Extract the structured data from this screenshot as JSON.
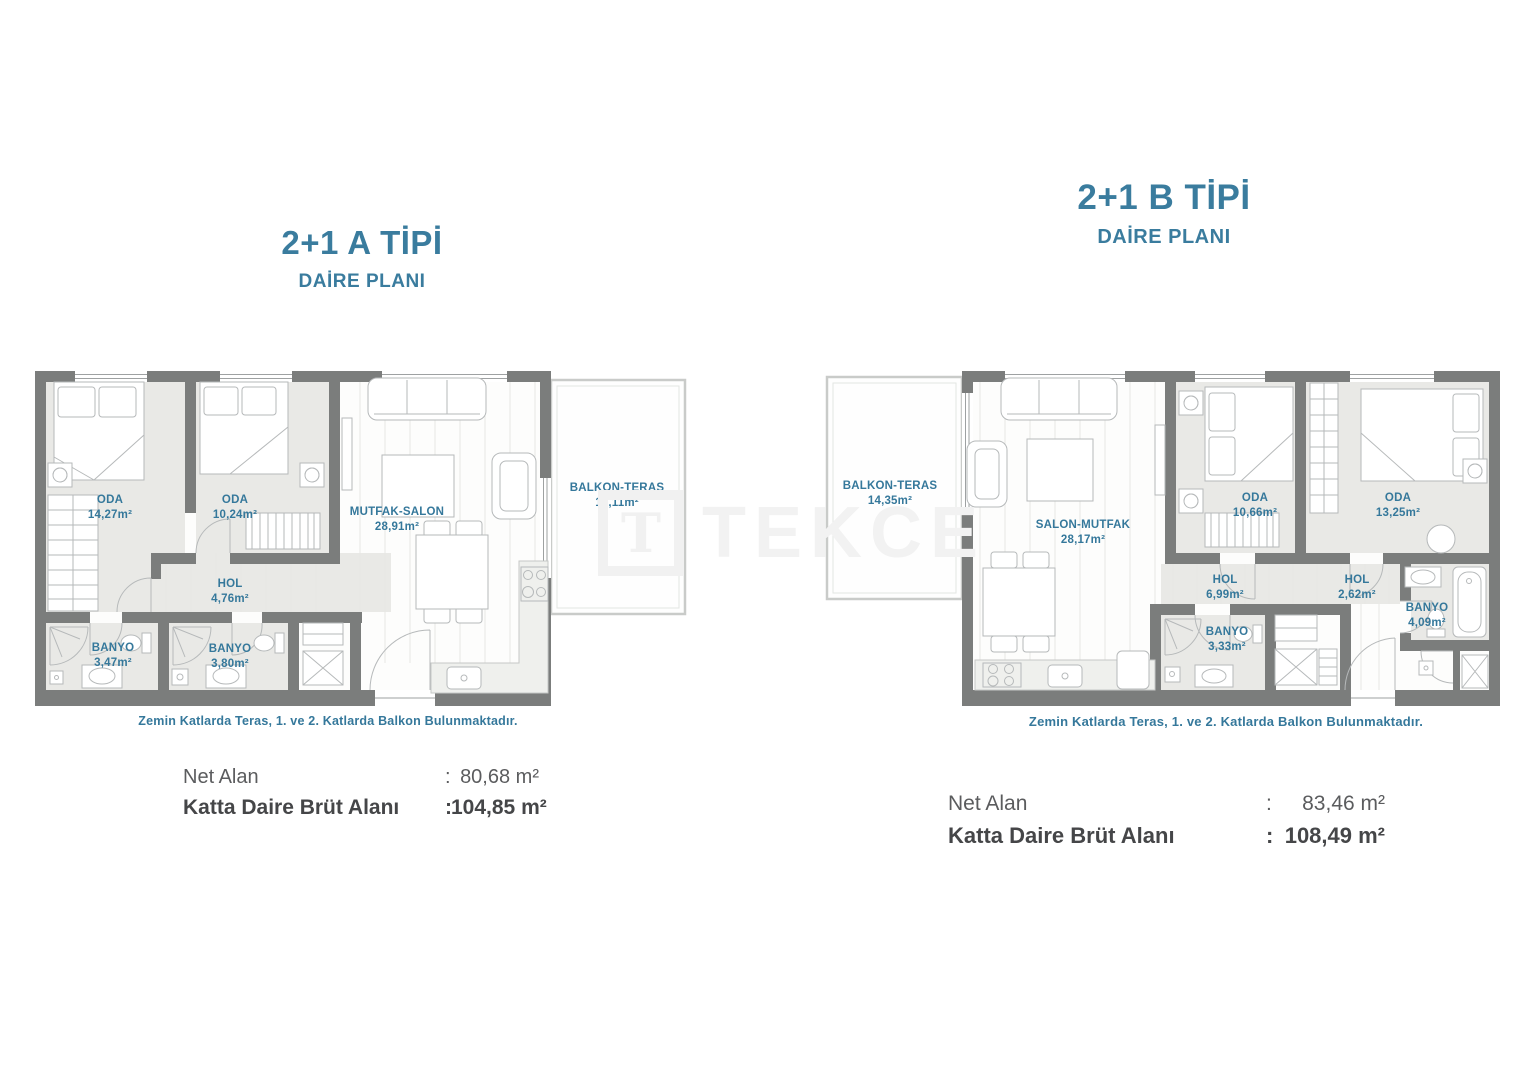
{
  "watermark": {
    "logo_letter": "T",
    "text": "TEKCE"
  },
  "colors": {
    "title_teal": "#3A7C9E",
    "label_teal": "#35789B",
    "wall_gray": "#7B7D7C",
    "room_fill": "#E9E9E6",
    "summary_dark": "#454648",
    "summary_gray": "#5B5C5E",
    "watermark_gray": "#F2F2F2"
  },
  "plans": [
    {
      "title": "2+1 A TİPİ",
      "subtitle": "DAİRE PLANI",
      "note": "Zemin Katlarda Teras, 1. ve 2. Katlarda Balkon Bulunmaktadır.",
      "rooms": [
        {
          "name": "ODA",
          "area": "14,27m²"
        },
        {
          "name": "ODA",
          "area": "10,24m²"
        },
        {
          "name": "MUTFAK-SALON",
          "area": "28,91m²"
        },
        {
          "name": "BALKON-TERAS",
          "area": "16,11m²"
        },
        {
          "name": "HOL",
          "area": "4,76m²"
        },
        {
          "name": "BANYO",
          "area": "3,47m²"
        },
        {
          "name": "BANYO",
          "area": "3,80m²"
        }
      ],
      "summary": {
        "net_label": "Net Alan",
        "net_sep": ":",
        "net_value": "80,68 m²",
        "gross_label": "Katta Daire Brüt Alanı",
        "gross_sep": ":",
        "gross_value": "104,85 m²"
      }
    },
    {
      "title": "2+1 B TİPİ",
      "subtitle": "DAİRE PLANI",
      "note": "Zemin Katlarda Teras, 1. ve 2. Katlarda Balkon Bulunmaktadır.",
      "rooms": [
        {
          "name": "BALKON-TERAS",
          "area": "14,35m²"
        },
        {
          "name": "SALON-MUTFAK",
          "area": "28,17m²"
        },
        {
          "name": "ODA",
          "area": "10,66m²"
        },
        {
          "name": "ODA",
          "area": "13,25m²"
        },
        {
          "name": "HOL",
          "area": "6,99m²"
        },
        {
          "name": "HOL",
          "area": "2,62m²"
        },
        {
          "name": "BANYO",
          "area": "3,33m²"
        },
        {
          "name": "BANYO",
          "area": "4,09m²"
        }
      ],
      "summary": {
        "net_label": "Net Alan",
        "net_sep": ":",
        "net_value": "83,46 m²",
        "gross_label": "Katta Daire Brüt Alanı",
        "gross_sep": ":",
        "gross_value": "108,49 m²"
      }
    }
  ]
}
